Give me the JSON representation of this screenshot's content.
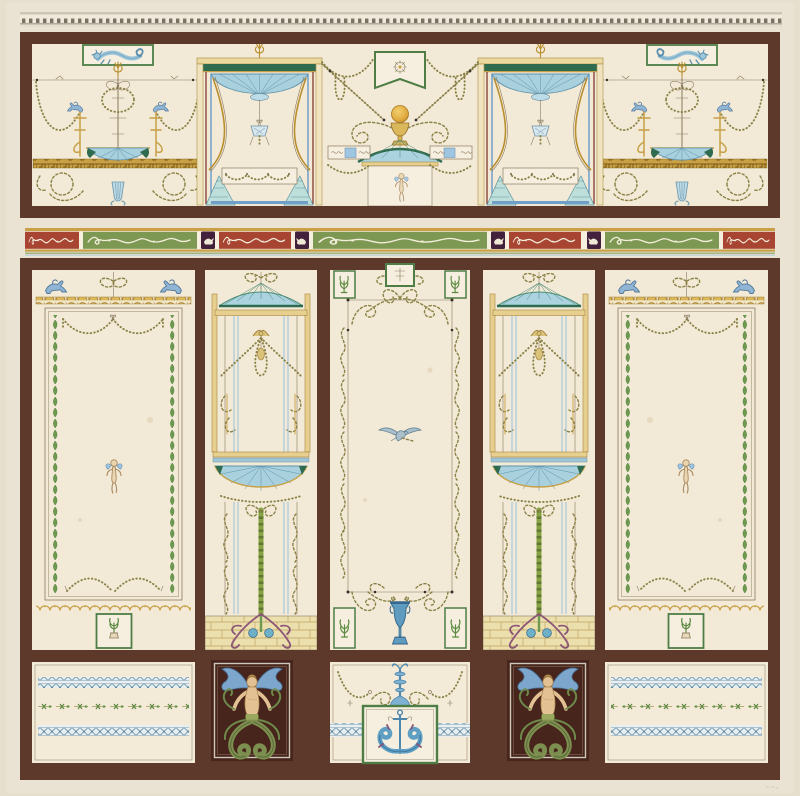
{
  "artwork": {
    "type": "neoclassical-wall-decoration-design",
    "style": "pompeian-arabesque-elevation",
    "visible_text": ""
  },
  "palette": {
    "paper": "#e7dfce",
    "field": "#f2e9d6",
    "cream_white": "#f6efdf",
    "frame_brown": "#5d392b",
    "mermaid_bg": "#48251c",
    "green_leaf": "#6d9a4f",
    "green_frame": "#4e7d46",
    "green_dark": "#2f6b4f",
    "green_band": "#7d9852",
    "gold": "#c8a045",
    "gold_pale": "#ecd9a0",
    "blue_canopy": "#a9d0dd",
    "blue_mid": "#6f9fc8",
    "blue_steel": "#6aa7c8",
    "red_band": "#a84532",
    "purple_block": "#43203b",
    "olive": "#8a8146",
    "sepia": "#8c7b60",
    "flesh": "#e3c193",
    "silver": "#cfc8ba",
    "tail_green": "#7d8f4e"
  },
  "sections": {
    "cornice": {
      "name": "cornice-molding",
      "motifs": [
        "dentil-course"
      ]
    },
    "frieze": {
      "name": "upper-frieze",
      "motifs": [
        "hippocamp-plaque",
        "arabesque-candelabrum",
        "bead-garland-swags",
        "blue-griffins",
        "canopy-pavilion",
        "hanging-lamp",
        "swallowtail-banner",
        "golden-orb-chalice",
        "dome-aedicule",
        "cupid-sketch",
        "greek-key-band",
        "blue-fluted-vase",
        "ornament-plaque-strip"
      ]
    },
    "ornament_band": {
      "name": "scrollwork-band",
      "segment_colors": [
        "red",
        "green",
        "purple"
      ],
      "motifs": [
        "white-scrollwork",
        "white-bird-block"
      ]
    },
    "main_wall": {
      "name": "main-panel-register",
      "panels": [
        "left-field-panel",
        "left-pilaster",
        "central-panel",
        "right-pilaster",
        "right-field-panel"
      ],
      "motifs": [
        "blue-griffin-pair",
        "egg-and-dart-band",
        "leaf-chain-border",
        "bead-swag",
        "winged-cupid",
        "scallop-band",
        "plant-plaque",
        "baldachin-dome",
        "fan-canopy",
        "thyrsus-stem",
        "brick-socle",
        "acanthus-scrolls",
        "vine-garland-frame",
        "flying-bird",
        "blue-urn"
      ]
    },
    "dado": {
      "name": "dado-register",
      "motifs": [
        "lattice-band",
        "floral-chain-band",
        "winged-siren-panel",
        "blue-candelabrum",
        "bead-swags",
        "dolphin-trident-plaque"
      ]
    }
  }
}
